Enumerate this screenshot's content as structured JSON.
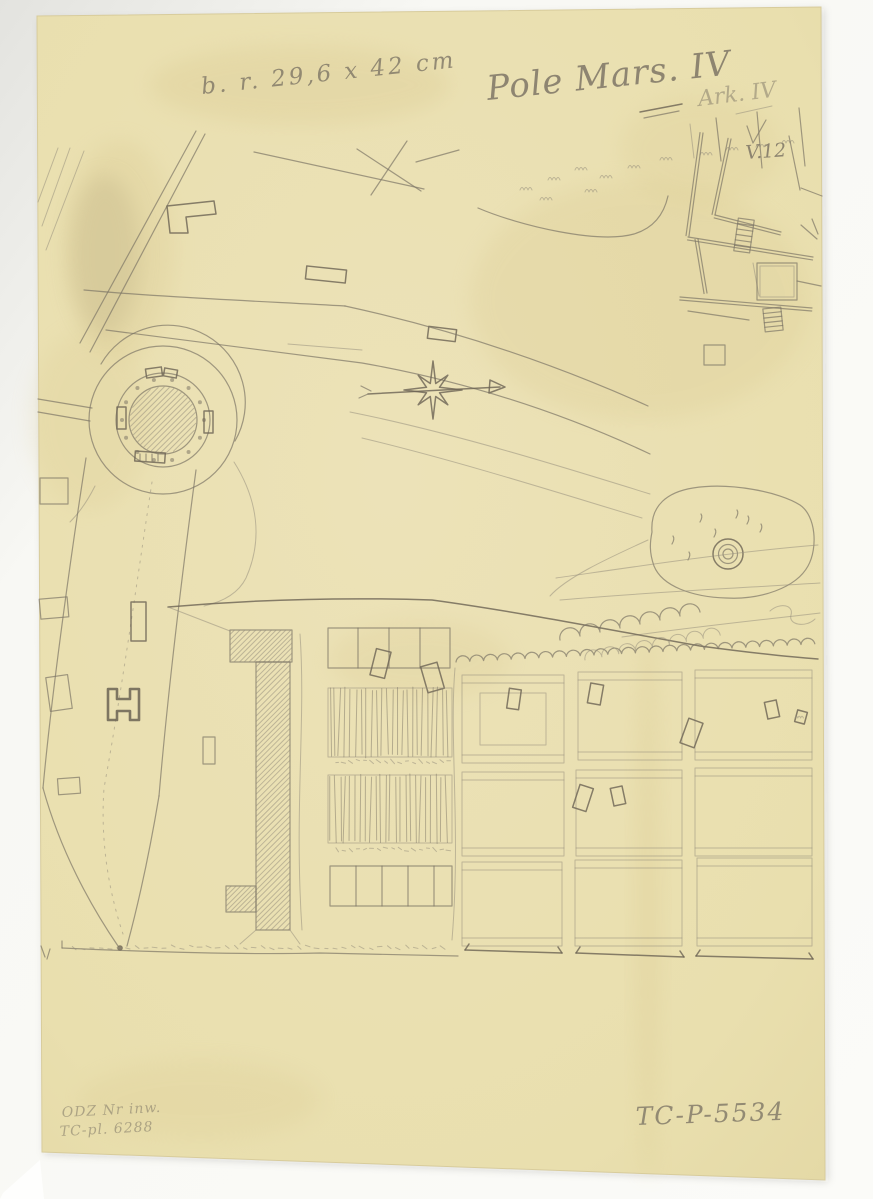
{
  "annotations": {
    "size_note": "b. r. 29,6 x 42 cm",
    "title": "Pole Mars. IV",
    "sheet_note": "Ark. IV",
    "check_mark_number": "V.12",
    "inventory_line1": "ODZ Nr inw.",
    "inventory_line2": "TC-pl. 6288",
    "catalog_number": "TC-P-5534"
  },
  "icons": {
    "compass_rose": "eight-point-star-with-east-arrow",
    "tree_symbol": "lollipop-tree-plan-symbol",
    "fountain": "concentric-circles"
  },
  "colors": {
    "paper": "#e9dfae",
    "paper_light": "#ede4bb",
    "pencil_dark": "#6b6354",
    "pencil_medium": "#7e7666",
    "pencil_light": "#988f7d",
    "scan_background": "#f8f8f4",
    "stain": "#d9c88e"
  }
}
